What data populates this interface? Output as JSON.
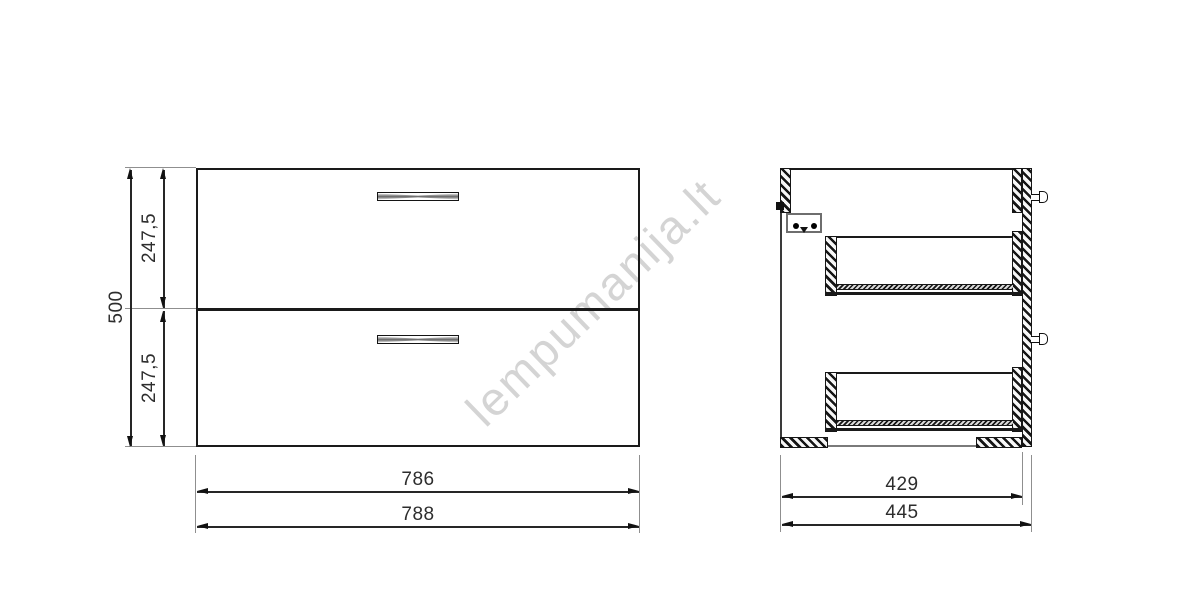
{
  "watermark": {
    "text": "lempumanija.lt",
    "color": "#d4d4d4"
  },
  "drawing": {
    "line_color": "#1a1a1a",
    "background": "#ffffff"
  },
  "front_view": {
    "dim_total_height": "500",
    "dim_top_drawer_height": "247,5",
    "dim_bottom_drawer_height": "247,5",
    "dim_width_inner": "786",
    "dim_width_outer": "788"
  },
  "side_view": {
    "dim_depth_inner": "429",
    "dim_depth_outer": "445"
  }
}
